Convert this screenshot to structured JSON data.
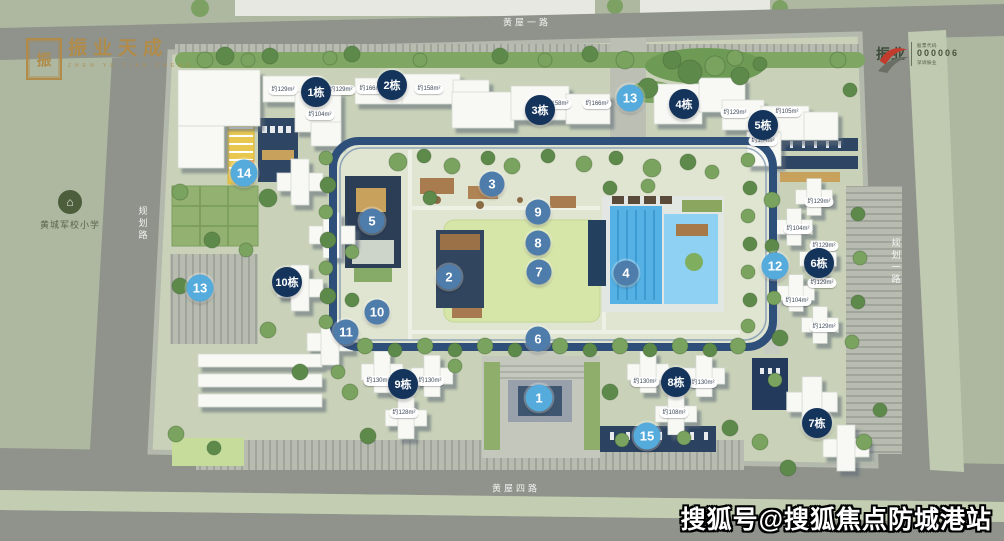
{
  "branding": {
    "logo_left": {
      "seal": "振",
      "title": "振业天成",
      "subtitle": "ZHEN YE TIAN CHENG"
    },
    "logo_right": {
      "name": "振业",
      "stock": {
        "caption_top": "股票代码",
        "code": "000006",
        "caption_bottom": "深圳振业"
      }
    }
  },
  "watermark": "搜狐号@搜狐焦点防城港站",
  "poi": {
    "school": {
      "label": "黄城军校小学"
    }
  },
  "roads": [
    {
      "id": "top",
      "label": "黄屋一路"
    },
    {
      "id": "bottom",
      "label": "黄屋四路"
    },
    {
      "id": "left",
      "label": "规划路"
    },
    {
      "id": "right",
      "label": "规划一路"
    }
  ],
  "markers": {
    "buildings": [
      {
        "label": "1栋",
        "x": 316,
        "y": 92
      },
      {
        "label": "2栋",
        "x": 392,
        "y": 85
      },
      {
        "label": "3栋",
        "x": 540,
        "y": 110
      },
      {
        "label": "4栋",
        "x": 684,
        "y": 104
      },
      {
        "label": "5栋",
        "x": 763,
        "y": 125
      },
      {
        "label": "6栋",
        "x": 819,
        "y": 263
      },
      {
        "label": "7栋",
        "x": 817,
        "y": 423
      },
      {
        "label": "8栋",
        "x": 676,
        "y": 382
      },
      {
        "label": "9栋",
        "x": 403,
        "y": 384
      },
      {
        "label": "10栋",
        "x": 287,
        "y": 282
      }
    ],
    "pois": [
      {
        "label": "1",
        "x": 539,
        "y": 398,
        "type": "cyan"
      },
      {
        "label": "2",
        "x": 449,
        "y": 277,
        "type": "slate"
      },
      {
        "label": "3",
        "x": 492,
        "y": 184,
        "type": "slate"
      },
      {
        "label": "4",
        "x": 626,
        "y": 273,
        "type": "slate"
      },
      {
        "label": "5",
        "x": 372,
        "y": 221,
        "type": "slate"
      },
      {
        "label": "6",
        "x": 538,
        "y": 339,
        "type": "slate"
      },
      {
        "label": "7",
        "x": 539,
        "y": 272,
        "type": "slate"
      },
      {
        "label": "8",
        "x": 538,
        "y": 243,
        "type": "slate"
      },
      {
        "label": "9",
        "x": 538,
        "y": 212,
        "type": "slate"
      },
      {
        "label": "10",
        "x": 377,
        "y": 312,
        "type": "slate"
      },
      {
        "label": "11",
        "x": 346,
        "y": 332,
        "type": "slate"
      },
      {
        "label": "12",
        "x": 775,
        "y": 266,
        "type": "cyan"
      },
      {
        "label": "13",
        "x": 630,
        "y": 98,
        "type": "cyan"
      },
      {
        "label": "13",
        "x": 200,
        "y": 288,
        "type": "cyan"
      },
      {
        "label": "14",
        "x": 244,
        "y": 173,
        "type": "cyan"
      },
      {
        "label": "15",
        "x": 647,
        "y": 436,
        "type": "cyan"
      }
    ]
  },
  "area_labels": [
    {
      "text": "约129m²",
      "x": 283,
      "y": 90
    },
    {
      "text": "约129m²",
      "x": 341,
      "y": 90
    },
    {
      "text": "约166m²",
      "x": 371,
      "y": 89
    },
    {
      "text": "约158m²",
      "x": 429,
      "y": 89
    },
    {
      "text": "约104m²",
      "x": 320,
      "y": 115
    },
    {
      "text": "约158m²",
      "x": 557,
      "y": 104
    },
    {
      "text": "约166m²",
      "x": 597,
      "y": 104
    },
    {
      "text": "约129m²",
      "x": 735,
      "y": 113
    },
    {
      "text": "约105m²",
      "x": 787,
      "y": 112
    },
    {
      "text": "约104m²",
      "x": 763,
      "y": 141
    },
    {
      "text": "约129m²",
      "x": 819,
      "y": 202
    },
    {
      "text": "约104m²",
      "x": 798,
      "y": 229
    },
    {
      "text": "约129m²",
      "x": 824,
      "y": 246
    },
    {
      "text": "约129m²",
      "x": 822,
      "y": 283
    },
    {
      "text": "约104m²",
      "x": 797,
      "y": 301
    },
    {
      "text": "约129m²",
      "x": 824,
      "y": 327
    },
    {
      "text": "约130m²",
      "x": 378,
      "y": 381
    },
    {
      "text": "约130m²",
      "x": 430,
      "y": 381
    },
    {
      "text": "约128m²",
      "x": 404,
      "y": 413
    },
    {
      "text": "约130m²",
      "x": 645,
      "y": 382
    },
    {
      "text": "约130m²",
      "x": 703,
      "y": 383
    },
    {
      "text": "约108m²",
      "x": 674,
      "y": 413
    }
  ],
  "colors": {
    "marker_building": "#14345c",
    "marker_poi": "#4e7cab",
    "marker_poi_alt": "#55acdc",
    "brand_gold": "#b08b4a",
    "brand_red": "#c23b2c",
    "pool_blue": "#55b0e3",
    "lawn_green": "#d6e6a9",
    "road_gray": "#8f938b"
  }
}
